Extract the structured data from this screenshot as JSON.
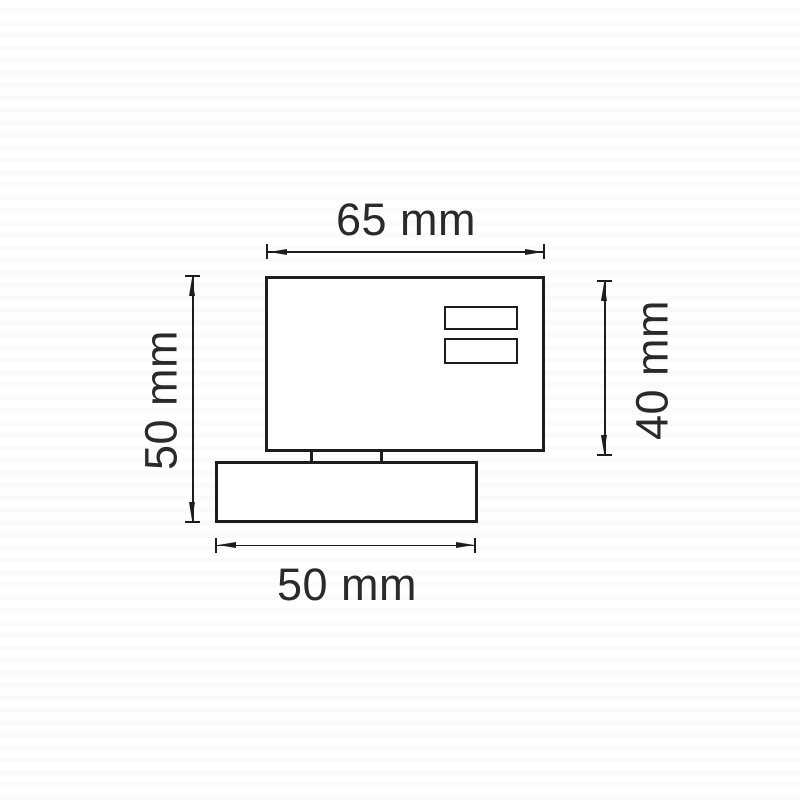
{
  "drawing": {
    "dimensions": {
      "top": {
        "label": "65 mm",
        "value": 65,
        "unit": "mm"
      },
      "left": {
        "label": "50 mm",
        "value": 50,
        "unit": "mm"
      },
      "right": {
        "label": "40 mm",
        "value": 40,
        "unit": "mm"
      },
      "bottom": {
        "label": "50 mm",
        "value": 50,
        "unit": "mm"
      }
    },
    "colors": {
      "line": "#1d1d1b",
      "text": "#2a2a28",
      "background": "#ffffff",
      "background_stripe": "#fafafa"
    }
  }
}
